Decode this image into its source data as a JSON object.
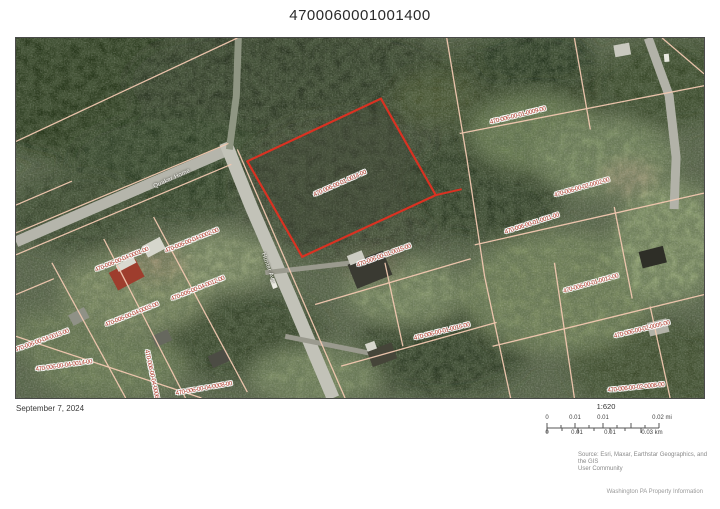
{
  "page": {
    "title": "4700060001001400",
    "date": "September 7, 2024",
    "footer": "Washington PA Property Information"
  },
  "map": {
    "highlight_color": "#d93222",
    "parcel_line_color": "#f3c9b1",
    "parcel_label_color": "#b03a2a",
    "parcel_labels": [
      {
        "text": "470-006-00-01-0014-00",
        "x": 324,
        "y": 146,
        "rot": -24
      },
      {
        "text": "470-006-00-01-0009-00",
        "x": 502,
        "y": 78,
        "rot": -14
      },
      {
        "text": "470-006-00-02-0002-00",
        "x": 566,
        "y": 150,
        "rot": -16
      },
      {
        "text": "470-006-00-01-0011-00",
        "x": 516,
        "y": 186,
        "rot": -18
      },
      {
        "text": "470-006-00-01-0012-00",
        "x": 575,
        "y": 246,
        "rot": -16
      },
      {
        "text": "470-006-00-02-0005-00",
        "x": 626,
        "y": 292,
        "rot": -14
      },
      {
        "text": "470-006-00-02-0008-00",
        "x": 620,
        "y": 350,
        "rot": -6
      },
      {
        "text": "470-006-00-01-0015-00",
        "x": 368,
        "y": 218,
        "rot": -20
      },
      {
        "text": "470-006-00-01-0016-00",
        "x": 426,
        "y": 294,
        "rot": -14
      },
      {
        "text": "470-006-00-04-0001-00",
        "x": 106,
        "y": 222,
        "rot": -22
      },
      {
        "text": "470-006-00-04-0002-00",
        "x": 176,
        "y": 203,
        "rot": -22
      },
      {
        "text": "470-006-00-04-0012-00",
        "x": 182,
        "y": 251,
        "rot": -22
      },
      {
        "text": "470-006-00-04-0003-00",
        "x": 116,
        "y": 277,
        "rot": -22
      },
      {
        "text": "470-006-00-04-0014-00",
        "x": 48,
        "y": 328,
        "rot": -8
      },
      {
        "text": "470-006-00-04-0008-00",
        "x": 188,
        "y": 351,
        "rot": -10
      },
      {
        "text": "470-006-00-04-0013-00",
        "x": 26,
        "y": 303,
        "rot": -20
      },
      {
        "text": "470-006-00-04-0006-00",
        "x": 136,
        "y": 340,
        "rot": 78
      }
    ],
    "street_labels": [
      {
        "text": "Quaker Home",
        "x": 156,
        "y": 141,
        "rot": -24
      },
      {
        "text": "Hunter Ave",
        "x": 252,
        "y": 230,
        "rot": 70
      }
    ],
    "attribution_line1": "Source: Esri, Maxar, Earthstar Geographics, and the GIS",
    "attribution_line2": "User Community"
  },
  "scalebar": {
    "ratio": "1:620",
    "mi_labels": [
      "0",
      "0.01",
      "0.01",
      "0.02 mi"
    ],
    "km_labels": [
      "0",
      "0.01",
      "0.01",
      "0.03 km"
    ]
  }
}
